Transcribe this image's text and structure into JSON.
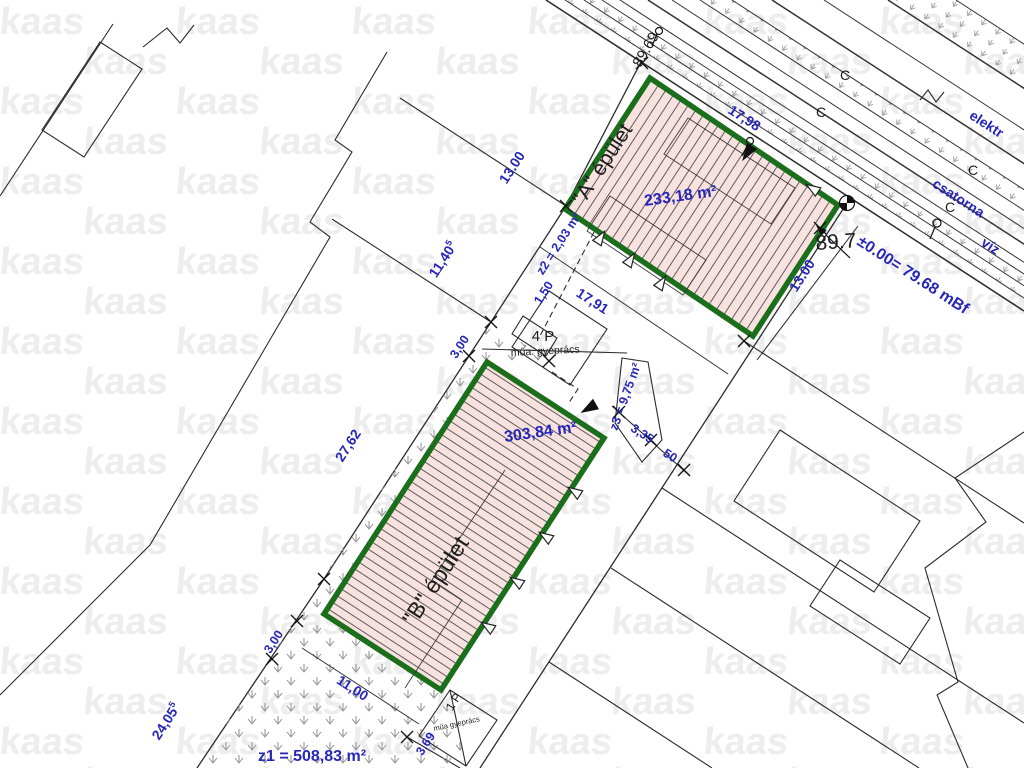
{
  "watermark": {
    "text": "kaas"
  },
  "plan": {
    "buildings": {
      "a": {
        "title": "\"A\" épület",
        "area": "233,18 m²"
      },
      "b": {
        "title": "\"B\" épület",
        "area": "303,84 m²"
      }
    },
    "areas": {
      "z1": "z1 = 508,83 m²",
      "z2": "z2 = 2,03 m²",
      "z3": "z3 = 9,75 m²"
    },
    "parking": {
      "p4": "4 P",
      "p4_note": "műa. gyeprács",
      "p1": "1 P",
      "p1_note": "műa gyeprács"
    },
    "levels": {
      "bench": "89.69",
      "corner": "89.7",
      "datum": "±0.00= 79.68 mBf"
    },
    "utilities": {
      "electric": "elektr",
      "sewer": "csatorna",
      "water": "víz",
      "sewer_mark": "C"
    },
    "dims": {
      "d13_nw": "13.00",
      "d11_40": "11,40",
      "d11_40_sup": "5",
      "d1_50": "1,50",
      "d17_98": "17,98",
      "d17_91": "17,91",
      "d13_se": "13.00",
      "d3_00_n": "3,00",
      "d27_62": "27,62",
      "d24_05": "24,05",
      "d24_05_sup": "5",
      "d3_00_s": "3,00",
      "d11_00": "11,00",
      "d3_35": "3,35",
      "d50": "50",
      "d3_69": "3,69"
    },
    "colors": {
      "dimension_blue": "#2626b8",
      "building_outline_green": "#1b6e1b",
      "building_fill_pink": "#f8e2e0"
    }
  }
}
